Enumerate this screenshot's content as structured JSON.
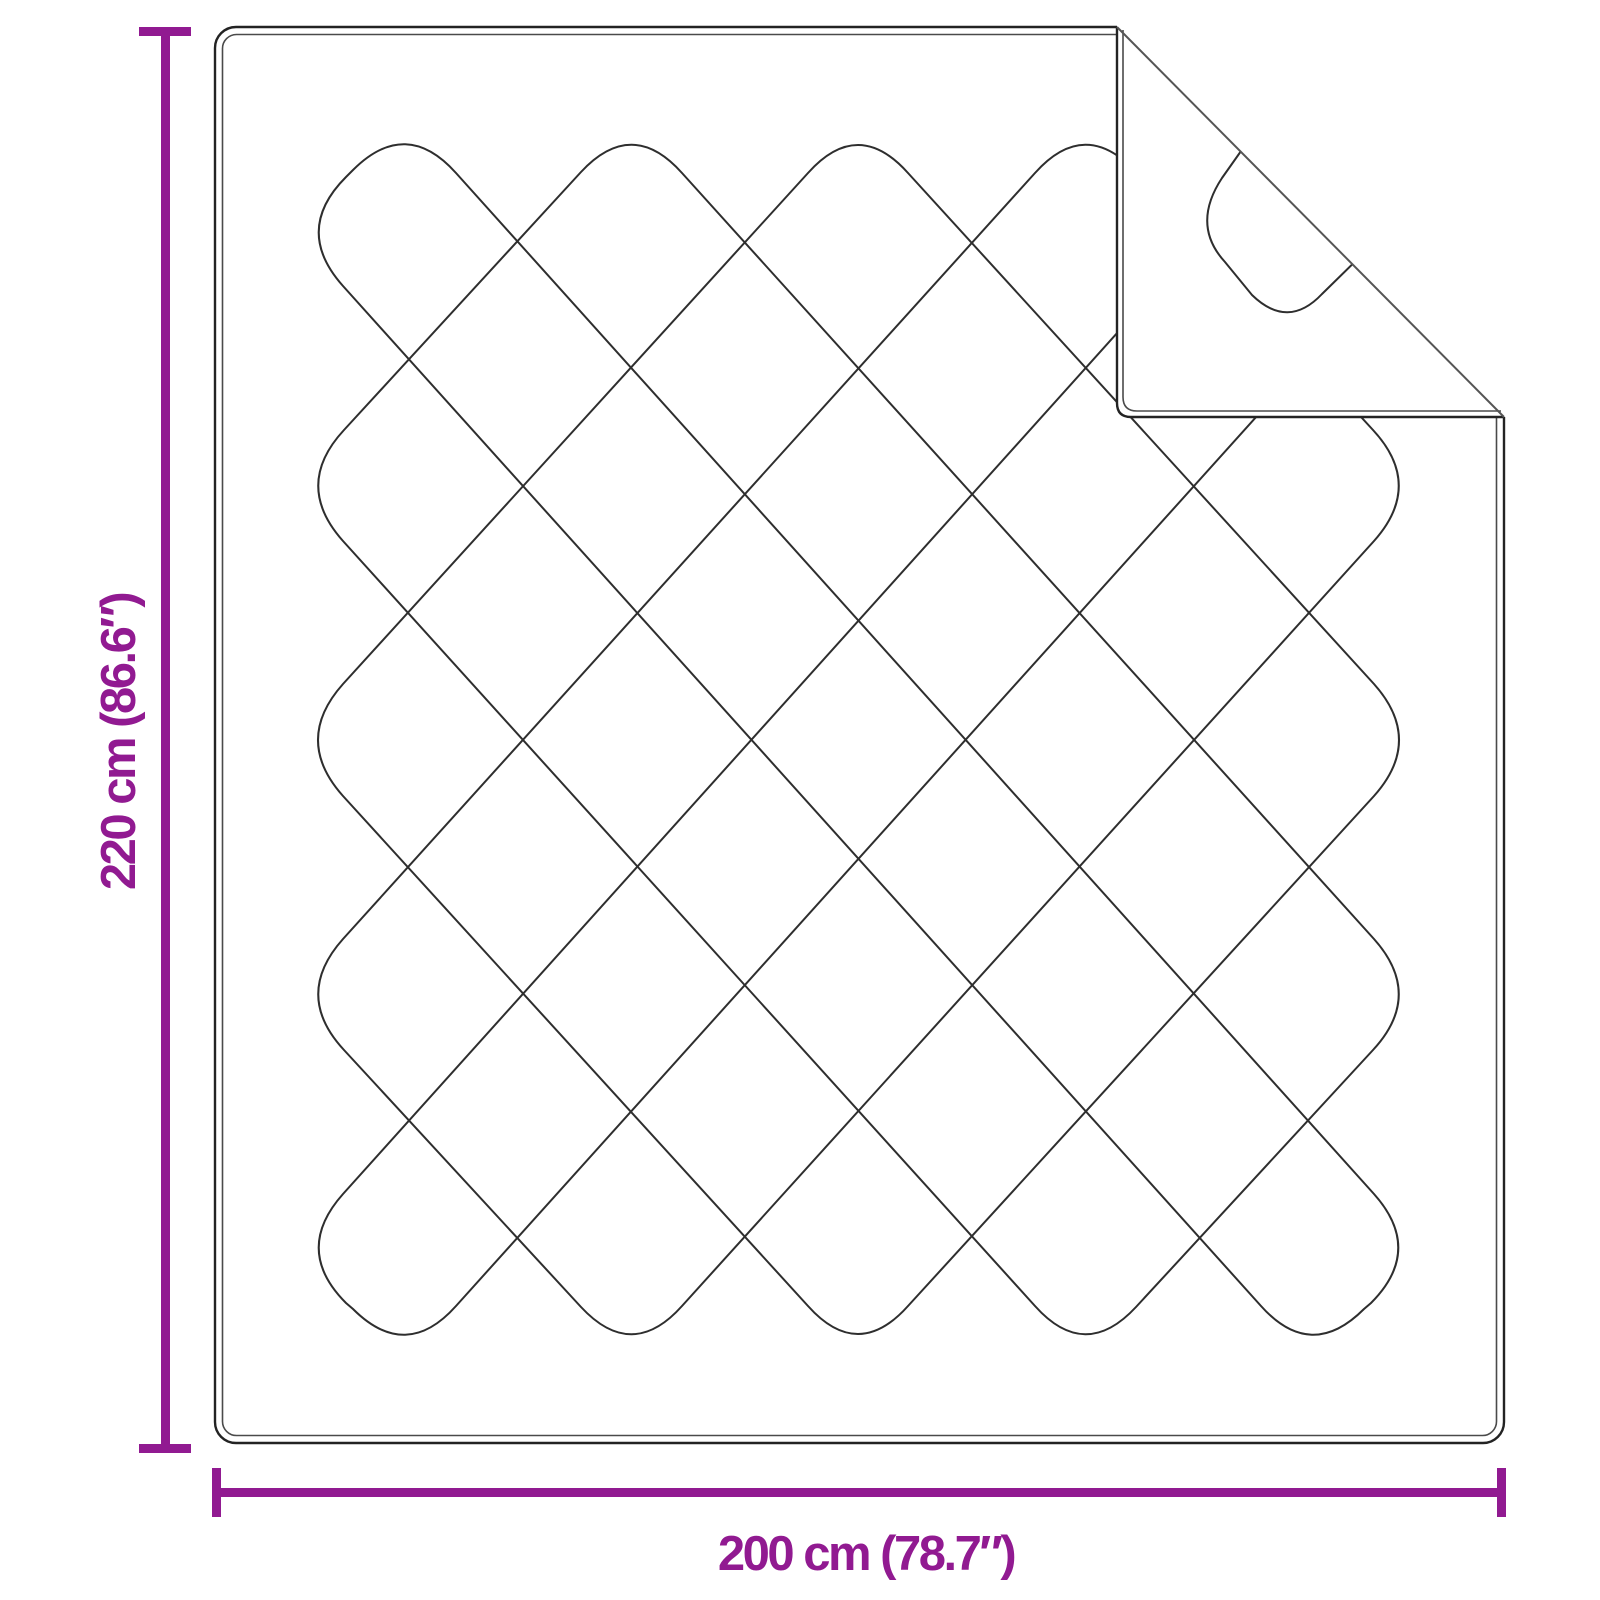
{
  "colors": {
    "accent": "#911A91",
    "outline": "#232323",
    "outline_inner": "#4A4A4A",
    "stitch": "#2E2E2E",
    "background": "#FFFFFF"
  },
  "figure": {
    "name": "quilted blanket top view with folded top-right corner",
    "height_dimension": {
      "label": "220 cm (86.6″)",
      "cm": 220,
      "inches": 86.6
    },
    "width_dimension": {
      "label": "200 cm (78.7″)",
      "cm": 200,
      "inches": 78.7
    }
  }
}
